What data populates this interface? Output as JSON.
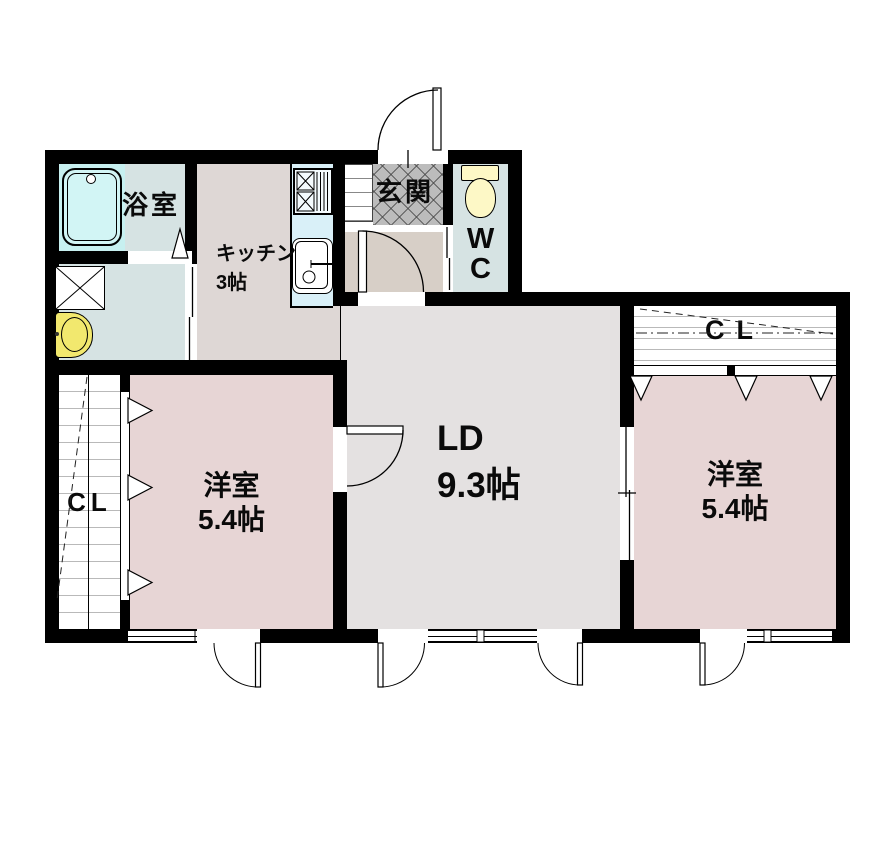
{
  "rooms": {
    "bathroom": {
      "label": "浴室"
    },
    "kitchen": {
      "lines": [
        "キッチン",
        "3帖"
      ]
    },
    "entrance": {
      "label": "玄関"
    },
    "toilet": {
      "lines": [
        "W",
        "C"
      ]
    },
    "living_dining": {
      "lines": [
        "LD",
        "9.3帖"
      ]
    },
    "bedroom_left": {
      "lines": [
        "洋室",
        "5.4帖"
      ]
    },
    "bedroom_right": {
      "lines": [
        "洋室",
        "5.4帖"
      ]
    },
    "closet_left": {
      "label": "CL"
    },
    "closet_right": {
      "label": "CL"
    }
  },
  "colors": {
    "wall": "#000000",
    "wet_floor": "#d6e3e3",
    "bath_unit": "#c7f0f0",
    "counter": "#d9f0f8",
    "kitchen_floor": "#ded7d5",
    "hall_floor": "#d7cfc7",
    "entrance_tile": "#bcbcbc",
    "living_floor": "#e4e1e1",
    "bedroom_floor": "#e7d5d5",
    "toilet_fixture": "#fdf8c6",
    "basin_fixture": "#f2e86e"
  }
}
